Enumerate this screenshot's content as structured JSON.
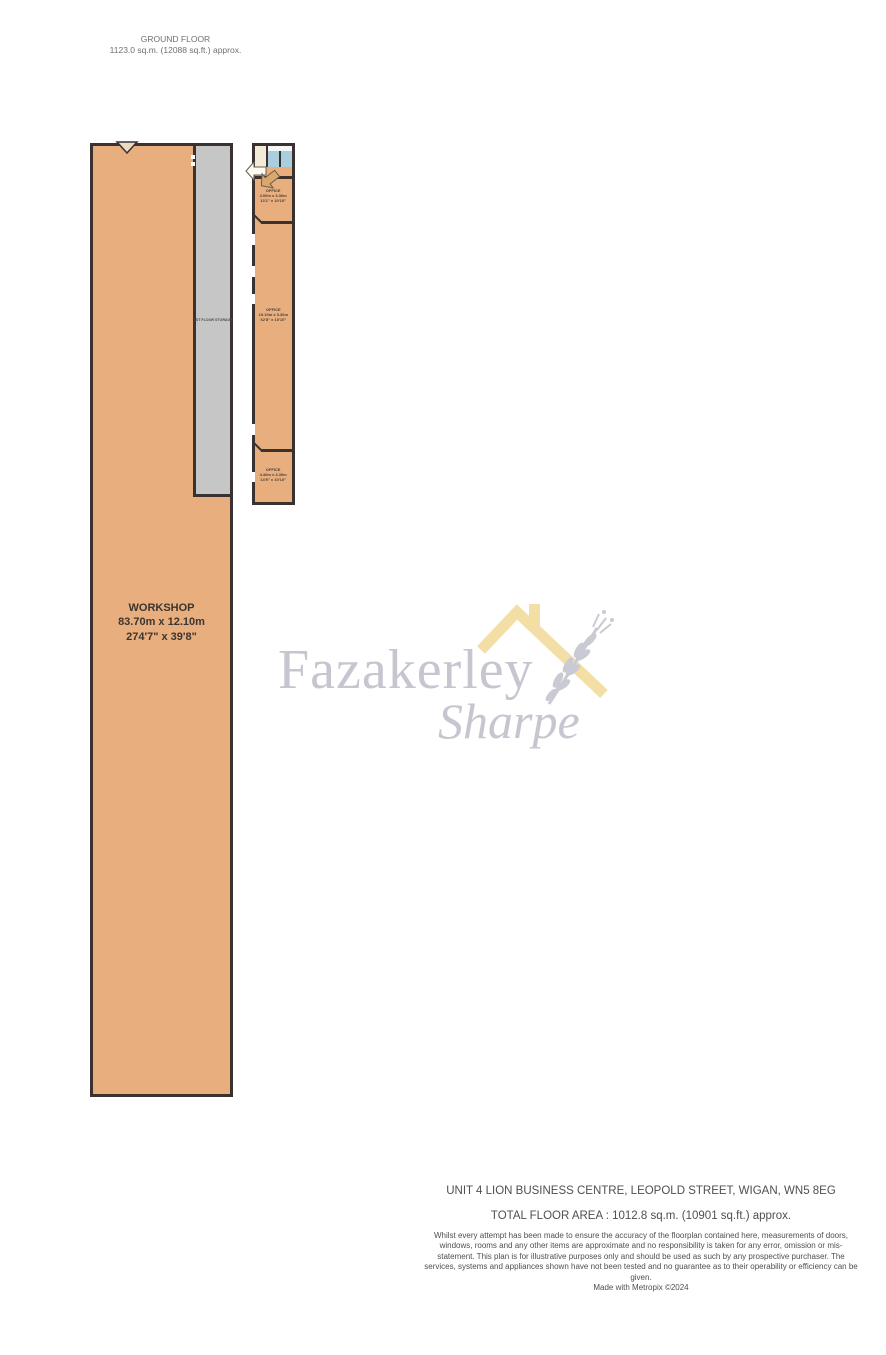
{
  "header": {
    "floor_label": "GROUND FLOOR",
    "floor_area": "1123.0 sq.m. (12088 sq.ft.) approx."
  },
  "rooms": {
    "workshop": {
      "name": "WORKSHOP",
      "dim_metric": "83.70m  x 12.10m",
      "dim_imperial": "274'7\"  x 39'8\""
    },
    "storage": {
      "name": "1ST FLOOR STORAGE"
    },
    "offices": [
      {
        "name": "OFFICE",
        "dim_metric": "4.00m x 3.30m",
        "dim_imperial": "13'1\" x 10'10\""
      },
      {
        "name": "OFFICE",
        "dim_metric": "19.10m x 3.30m",
        "dim_imperial": "62'8\" x 10'10\""
      },
      {
        "name": "OFFICE",
        "dim_metric": "4.40m x 3.30m",
        "dim_imperial": "14'5\" x 10'10\""
      }
    ]
  },
  "watermark": {
    "line1": "Fazakerley",
    "line2": "Sharpe"
  },
  "footer": {
    "address": "UNIT 4 LION BUSINESS CENTRE, LEOPOLD STREET, WIGAN, WN5 8EG",
    "total_area": "TOTAL FLOOR AREA : 1012.8 sq.m. (10901 sq.ft.) approx.",
    "disclaimer": "Whilst every attempt has been made to ensure the accuracy of the floorplan contained here, measurements of doors, windows, rooms and any other items are approximate and no responsibility is taken for any error, omission or mis-statement. This plan is for illustrative purposes only and should be used as such by any prospective purchaser. The services, systems and appliances shown have not been tested and no guarantee as to their operability or efficiency can be given.",
    "credit": "Made with Metropix ©2024"
  },
  "colors": {
    "room_fill": "#e8ae7d",
    "storage_fill": "#c6c6c6",
    "wall": "#3a3231",
    "fixture_blue": "#a9cede",
    "fixture_cream": "#f2ebd7",
    "watermark_text": "#c6c6d0",
    "watermark_roof": "#f3dfa6",
    "watermark_branch": "#c9cad3",
    "header_text": "#6f6f6f",
    "footer_text": "#4f4f4f"
  }
}
